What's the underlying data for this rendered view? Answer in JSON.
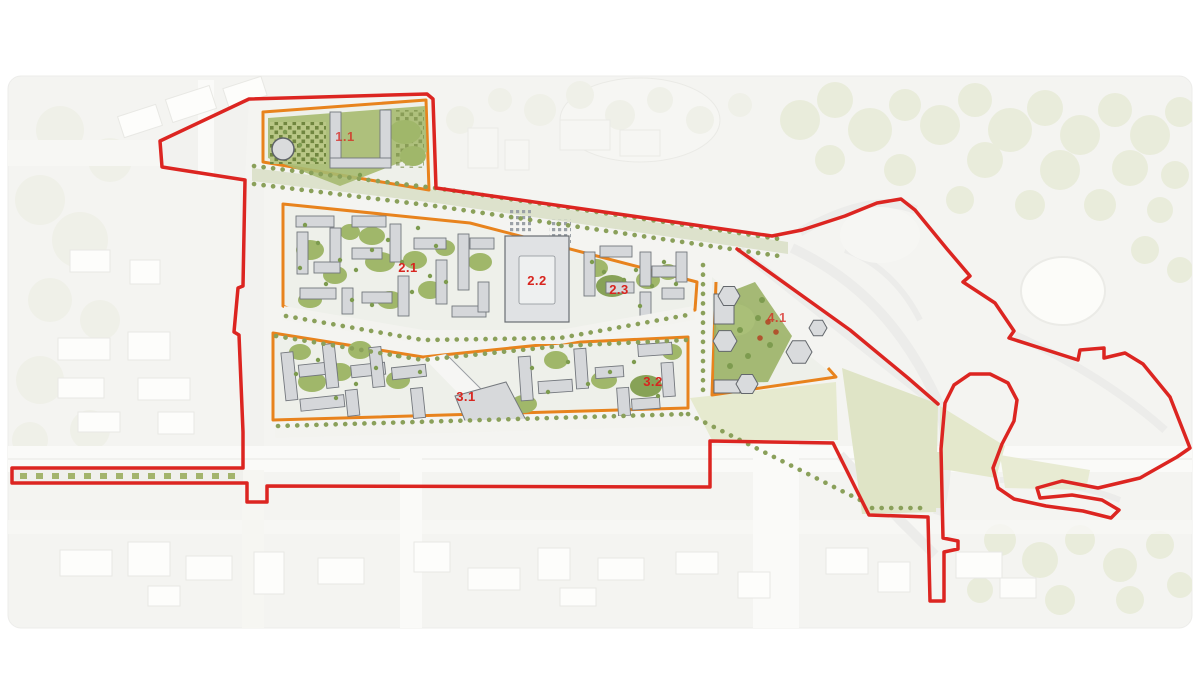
{
  "map": {
    "page_background": "#ffffff",
    "background_color": "#f4f4f1",
    "site_boundary_color": "#dc2521",
    "zone_outline_color": "#e8831d",
    "zone_label_color": "#d8251f",
    "building_color": "#d5d7da",
    "courtyard_green": "#9fb56a",
    "context_green": "#e9ecdb",
    "zones": [
      {
        "id": "zone-1-1",
        "label": "1.1"
      },
      {
        "id": "zone-2-1",
        "label": "2.1"
      },
      {
        "id": "zone-2-2",
        "label": "2.2"
      },
      {
        "id": "zone-2-3",
        "label": "2.3"
      },
      {
        "id": "zone-3-1",
        "label": "3.1"
      },
      {
        "id": "zone-3-2",
        "label": "3.2"
      },
      {
        "id": "zone-4-1",
        "label": "4.1"
      }
    ]
  }
}
